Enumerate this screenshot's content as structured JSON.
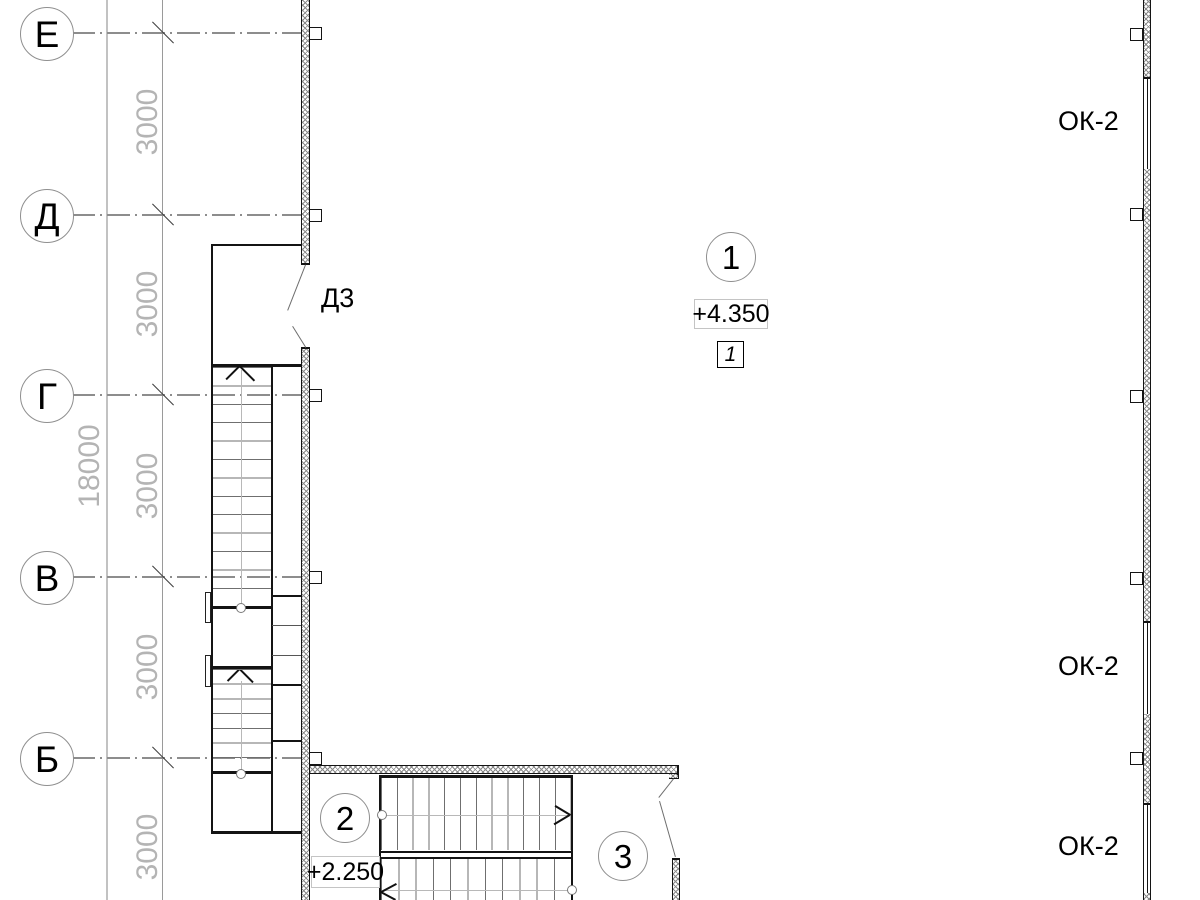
{
  "grid": {
    "letters": [
      "Е",
      "Д",
      "Г",
      "В",
      "Б"
    ],
    "total_dim": "18000",
    "bay_dims": [
      "3000",
      "3000",
      "3000",
      "3000",
      "3000"
    ]
  },
  "labels": {
    "door": "Д3",
    "windows": [
      "ОК-2",
      "ОК-2",
      "ОК-2"
    ]
  },
  "markers": {
    "circles": [
      "1",
      "2",
      "3"
    ],
    "level_box": "1"
  },
  "elevations": {
    "upper": "+4.350",
    "lower": "+2.250"
  },
  "colors": {
    "line_dark": "#141414",
    "line_gray": "#8d8d8d",
    "dim_text": "#b4b4b4"
  }
}
